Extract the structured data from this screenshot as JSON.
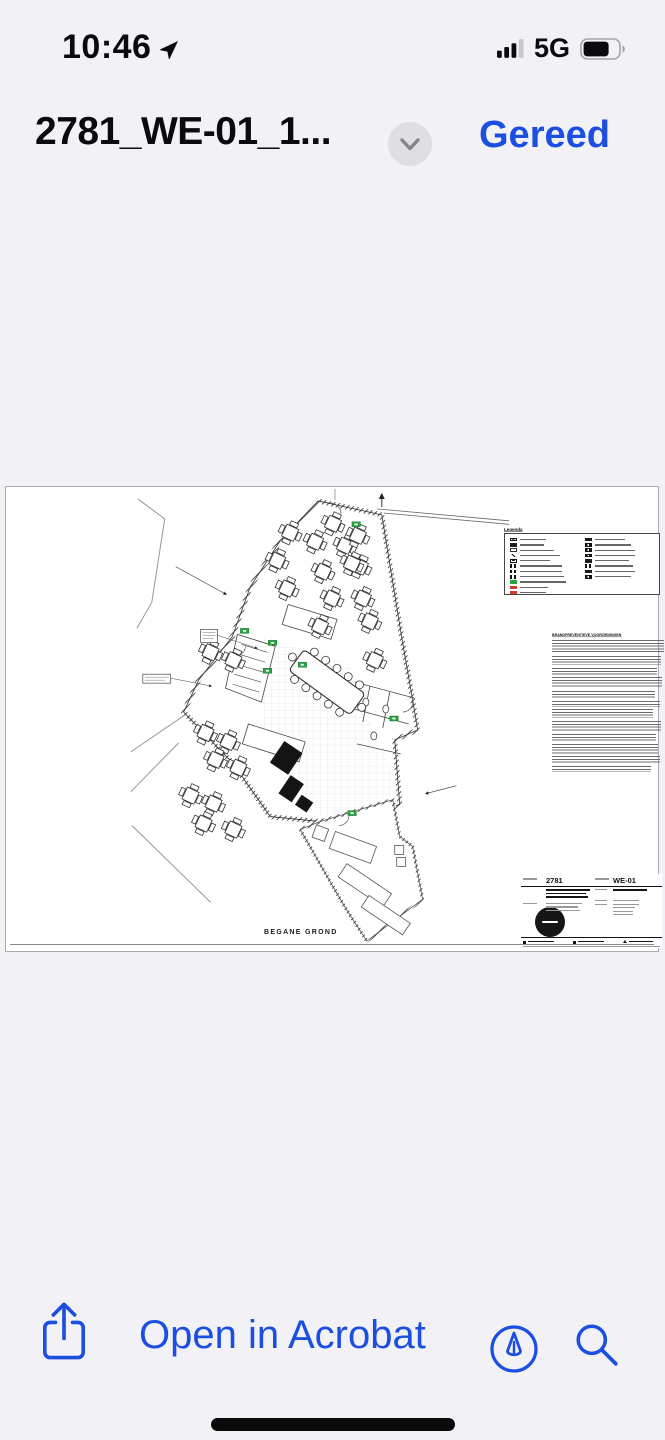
{
  "status_bar": {
    "time": "10:46",
    "network": "5G",
    "battery_level": "75%"
  },
  "nav": {
    "title": "2781_WE-01_1...",
    "done": "Gereed"
  },
  "toolbar": {
    "open_in": "Open in Acrobat"
  },
  "sheet": {
    "floor_label": "BEGANE GROND",
    "legend_title": "Legenda",
    "notes_title": "BRANDPREVENTIEVE VOORZIENINGEN",
    "project_number": "2781",
    "drawing_number": "WE-01"
  },
  "colors": {
    "accent": "#1D4EE2",
    "exit_green": "#27A53F",
    "alarm_red": "#D43B30",
    "background": "#F2F2F6"
  },
  "icons": {
    "location": "navigation-arrow",
    "signal": "cellular-bars-3of4",
    "battery": "battery-three-quarters",
    "disclosure": "chevron-down",
    "share": "square-and-arrow-up",
    "markup": "pen-nib-in-circle",
    "search": "magnifier"
  }
}
